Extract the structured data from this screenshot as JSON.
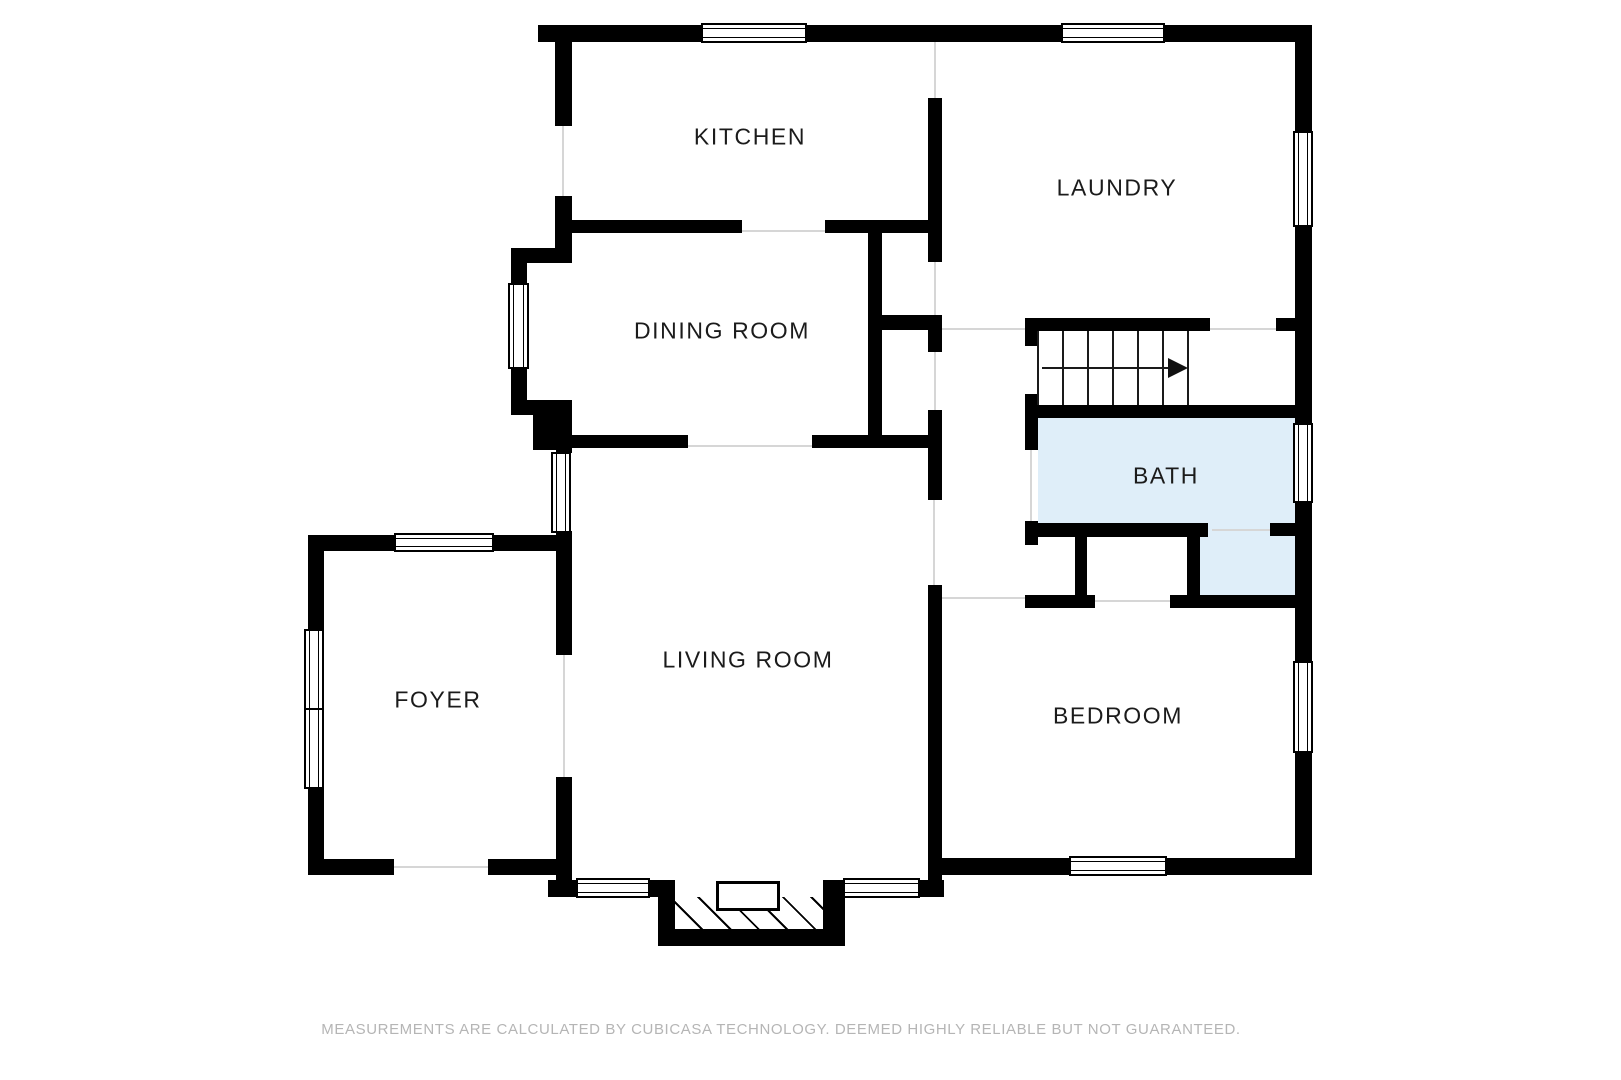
{
  "floorplan": {
    "rooms": {
      "kitchen": "KITCHEN",
      "laundry": "LAUNDRY",
      "dining": "DINING ROOM",
      "bath": "BATH",
      "foyer": "FOYER",
      "living": "LIVING ROOM",
      "bedroom": "BEDROOM"
    },
    "stairs": {
      "steps": 6,
      "direction": "right"
    },
    "colors": {
      "wall": "#000000",
      "bath_fill": "#dfeef9",
      "label": "#1b1b1b",
      "disclaimer_text": "#b5b5b5"
    },
    "disclaimer": "MEASUREMENTS ARE CALCULATED BY CUBICASA TECHNOLOGY. DEEMED HIGHLY RELIABLE BUT NOT GUARANTEED."
  }
}
